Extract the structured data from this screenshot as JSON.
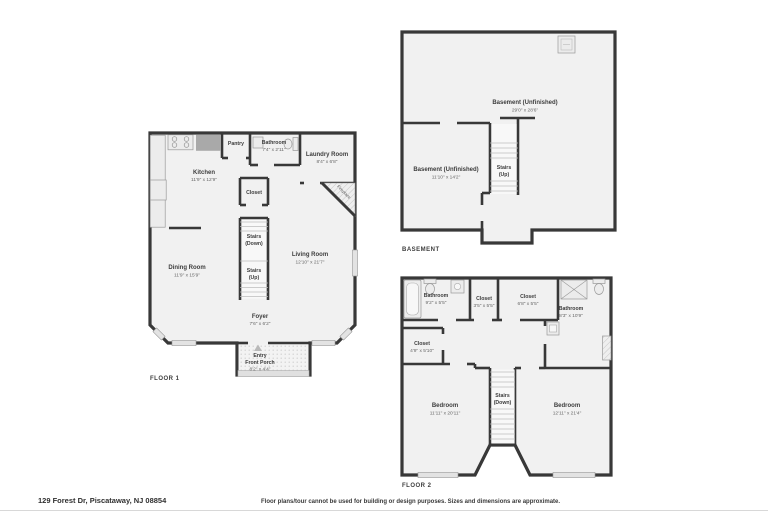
{
  "footer": {
    "address": "129 Forest Dr, Piscataway, NJ 08854",
    "disclaimer": "Floor plans/tour cannot be used for building or design purposes. Sizes and dimensions are approximate."
  },
  "colors": {
    "wall": "#383838",
    "floor": "#f1f1f1",
    "fixture": "#ececec"
  },
  "icons": [
    "entry-arrow-icon",
    "stove-icon",
    "refrigerator-icon",
    "counter-icon",
    "sink-icon",
    "toilet-icon",
    "bathtub-icon",
    "shower-icon",
    "utility-box-icon",
    "fireplace-icon"
  ],
  "floor1": {
    "caption": "FLOOR 1",
    "rooms": {
      "kitchen": {
        "name": "Kitchen",
        "dims": "11'9\" x 12'9\""
      },
      "pantry": {
        "name": "Pantry"
      },
      "bathroom": {
        "name": "Bathroom",
        "dims": "7'4\" x 2'11\""
      },
      "laundry": {
        "name": "Laundry Room",
        "dims": "8'4\" x 6'8\""
      },
      "fireplace": {
        "name": "Fireplace"
      },
      "closet": {
        "name": "Closet"
      },
      "stairs_down": {
        "line1": "Stairs",
        "line2": "(Down)"
      },
      "stairs_up": {
        "line1": "Stairs",
        "line2": "(Up)"
      },
      "dining": {
        "name": "Dining Room",
        "dims": "11'9\" x 15'9\""
      },
      "living": {
        "name": "Living Room",
        "dims": "12'10\" x 21'7\""
      },
      "foyer": {
        "name": "Foyer",
        "dims": "7'6\" x 6'2\""
      },
      "porch": {
        "line1": "Entry",
        "line2": "Front Porch",
        "dims": "8'2\" x 4'4\""
      }
    }
  },
  "basement": {
    "caption": "BASEMENT",
    "rooms": {
      "main": {
        "name": "Basement (Unfinished)",
        "dims": "29'0\" x 28'6\""
      },
      "second": {
        "name": "Basement (Unfinished)",
        "dims": "11'10\" x 14'2\""
      },
      "stairs": {
        "line1": "Stairs",
        "line2": "(Up)"
      }
    }
  },
  "floor2": {
    "caption": "FLOOR 2",
    "rooms": {
      "bathroom_left": {
        "name": "Bathroom",
        "dims": "9'2\" x 5'5\""
      },
      "closet_small": {
        "name": "Closet",
        "dims": "3'5\" x 5'5\""
      },
      "closet_mid": {
        "name": "Closet",
        "dims": "6'8\" x 5'5\""
      },
      "bathroom_right": {
        "name": "Bathroom",
        "dims": "8'3\" x 10'9\""
      },
      "closet_left": {
        "name": "Closet",
        "dims": "4'9\" x 5'10\""
      },
      "bedroom_left": {
        "name": "Bedroom",
        "dims": "11'11\" x 20'11\""
      },
      "bedroom_right": {
        "name": "Bedroom",
        "dims": "12'11\" x 21'4\""
      },
      "stairs": {
        "line1": "Stairs",
        "line2": "(Down)"
      }
    }
  }
}
